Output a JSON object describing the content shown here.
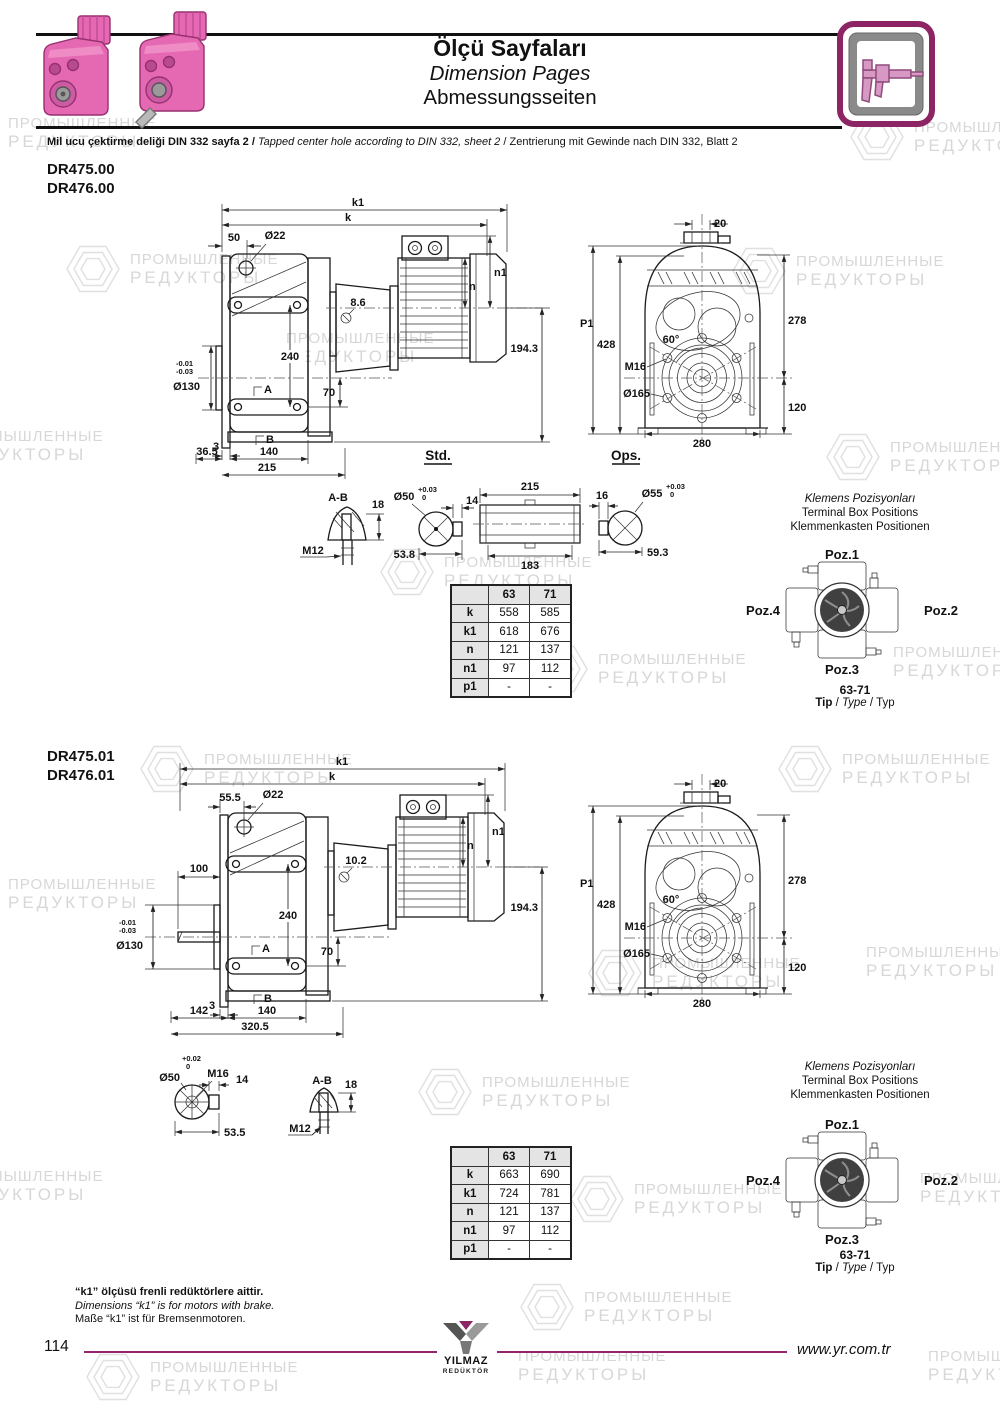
{
  "watermark": {
    "line1": "ПРОМЫШЛЕННЫЕ",
    "line2": "РЕДУКТОРЫ"
  },
  "header": {
    "title_tr": "Ölçü Sayfaları",
    "title_en": "Dimension Pages",
    "title_de": "Abmessungsseiten",
    "note_tr": "Mil ucu çektirme deliği DIN 332 sayfa 2",
    "note_en": "Tapped center hole according to DIN 332, sheet 2",
    "note_de": "Zentrierung mit Gewinde nach DIN 332, Blatt 2",
    "sep": "/"
  },
  "sections": [
    {
      "model1": "DR475.00",
      "model2": "DR476.00",
      "side": {
        "k1": "k1",
        "k": "k",
        "w": "50",
        "d22": "Ø22",
        "screw": "8.6",
        "n1": "n1",
        "n": "n",
        "h": "194.3",
        "v240": "240",
        "d130": "Ø130",
        "tol1": "-0.01",
        "tol2": "-0.03",
        "a": "A",
        "v70": "70",
        "off": "3",
        "b": "B",
        "b1": "36.5",
        "b2": "140",
        "b3": "215"
      },
      "front": {
        "t20": "20",
        "p1": "P1",
        "h428": "428",
        "ang": "60°",
        "m16": "M16",
        "d165": "Ø165",
        "h278": "278",
        "h120": "120",
        "w280": "280"
      },
      "det": {
        "std": "Std.",
        "ops": "Ops.",
        "ab": "A-B",
        "k18": "18",
        "m12": "M12",
        "d50": "Ø50",
        "tp": "+0.03",
        "tz": "0",
        "w14": "14",
        "l1": "53.8",
        "t215": "215",
        "b183": "183",
        "w16": "16",
        "d55": "Ø55",
        "tp2": "+0.03",
        "tz2": "0",
        "l2": "59.3"
      },
      "table": {
        "h1": "63",
        "h2": "71",
        "rows": [
          [
            "k",
            "558",
            "585"
          ],
          [
            "k1",
            "618",
            "676"
          ],
          [
            "n",
            "121",
            "137"
          ],
          [
            "n1",
            "97",
            "112"
          ],
          [
            "p1",
            "-",
            "-"
          ]
        ]
      },
      "term": {
        "t1": "Klemens Pozisyonları",
        "t2": "Terminal Box Positions",
        "t3": "Klemmenkasten Positionen",
        "p1": "Poz.1",
        "p2": "Poz.2",
        "p3": "Poz.3",
        "p4": "Poz.4",
        "range": "63-71",
        "tip": "Tip",
        "type": "Type",
        "typ": "Typ",
        "sep": "/"
      }
    },
    {
      "model1": "DR475.01",
      "model2": "DR476.01",
      "side": {
        "k1": "k1",
        "k": "k",
        "w": "55.5",
        "d22": "Ø22",
        "screw": "10.2",
        "w100": "100",
        "n1": "n1",
        "n": "n",
        "h": "194.3",
        "v240": "240",
        "d130": "Ø130",
        "tol1": "-0.01",
        "tol2": "-0.03",
        "a": "A",
        "v70": "70",
        "off": "3",
        "b": "B",
        "b1": "142",
        "b2": "140",
        "b3": "320.5"
      },
      "front": {
        "t20": "20",
        "p1": "P1",
        "h428": "428",
        "ang": "60°",
        "m16": "M16",
        "d165": "Ø165",
        "h278": "278",
        "h120": "120",
        "w280": "280"
      },
      "det": {
        "d50": "Ø50",
        "tp": "+0.02",
        "tz": "0",
        "m16": "M16",
        "w14": "14",
        "l1": "53.5",
        "ab": "A-B",
        "k18": "18",
        "m12": "M12"
      },
      "table": {
        "h1": "63",
        "h2": "71",
        "rows": [
          [
            "k",
            "663",
            "690"
          ],
          [
            "k1",
            "724",
            "781"
          ],
          [
            "n",
            "121",
            "137"
          ],
          [
            "n1",
            "97",
            "112"
          ],
          [
            "p1",
            "-",
            "-"
          ]
        ]
      },
      "term": {
        "t1": "Klemens Pozisyonları",
        "t2": "Terminal Box Positions",
        "t3": "Klemmenkasten Positionen",
        "p1": "Poz.1",
        "p2": "Poz.2",
        "p3": "Poz.3",
        "p4": "Poz.4",
        "range": "63-71",
        "tip": "Tip",
        "type": "Type",
        "typ": "Typ",
        "sep": "/"
      }
    }
  ],
  "footer": {
    "note_tr": "“k1” ölçüsü frenli redüktörlere aittir.",
    "note_en": "Dimensions “k1” is for motors with brake.",
    "note_de": "Maße “k1” ist für Bremsenmotoren.",
    "page": "114",
    "url": "www.yr.com.tr",
    "logo1": "YILMAZ",
    "logo2": "REDÜKTÖR"
  },
  "colors": {
    "accent": "#93246d",
    "pink": "#e569b2",
    "watermark": "#d7d7d7"
  }
}
